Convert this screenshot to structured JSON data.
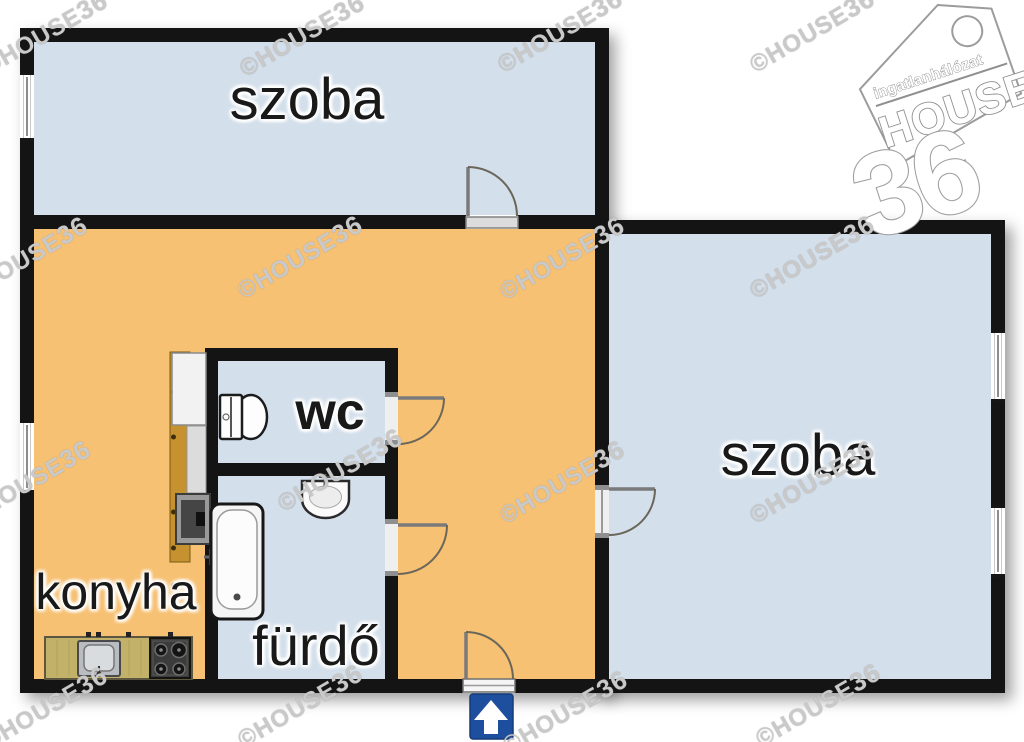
{
  "labels": {
    "room_top": "szoba",
    "room_right": "szoba",
    "kitchen": "konyha",
    "wc": "wc",
    "bathroom": "fürdő"
  },
  "branding": {
    "watermark_prefix": "©HOUSE",
    "watermark_suffix": "36",
    "logo_network": "ingatlanhálózat",
    "logo_name": "HOUSE",
    "logo_number": "36"
  },
  "icons": {
    "entrance": "up-arrow-entrance-sign",
    "toilet": "toilet-top-view",
    "washbasin": "washbasin-top-view",
    "bathtub": "bathtub-top-view",
    "kitchen_sink": "kitchen-sink-top-view",
    "stove": "gas-stove-top-view"
  },
  "colors": {
    "wall": "#141414",
    "room_fill": "#d3dfeb",
    "hall_fill": "#f7c173",
    "wood": "#c6922f",
    "counter": "#c2b168",
    "arrow_sign": "#1d4f9e",
    "watermark": "#c9c9c9",
    "label": "#191919",
    "door_arc": "#6b665a",
    "logo_outline": "#9c9c9c"
  }
}
